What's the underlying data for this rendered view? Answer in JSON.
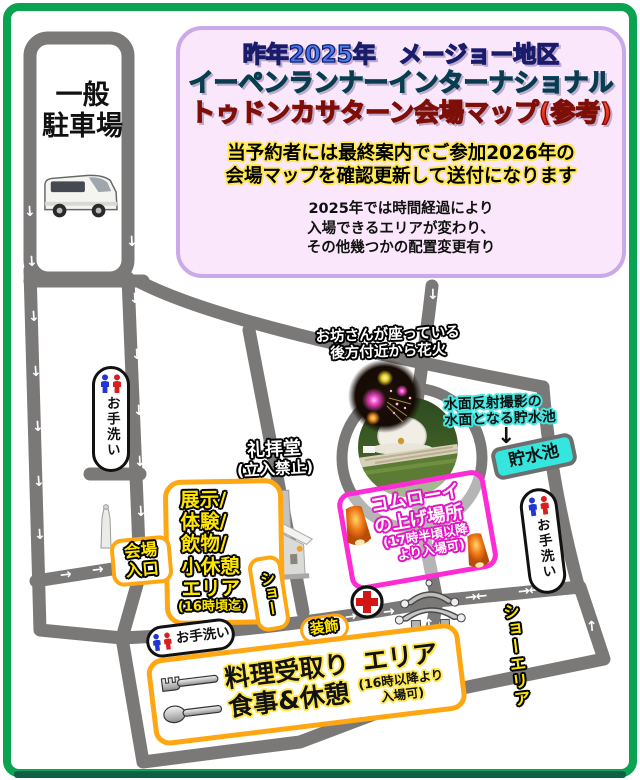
{
  "header": {
    "title_line1": "昨年2025年　メージョー地区",
    "title_line2": "イーペンランナーインターナショナル",
    "title_line3": "トゥドンカサターン会場マップ(参考)",
    "notice_line1": "当予約者には最終案内でご参加2026年の",
    "notice_line2": "会場マップを確認更新して送付になります",
    "note_line1": "2025年では時間経過により",
    "note_line2": "入場できるエリアが変わり、",
    "note_line3": "その他幾つかの配置変更有り"
  },
  "parking": {
    "line1": "一般",
    "line2": "駐車場"
  },
  "map": {
    "fireworks_caption": {
      "line1": "お坊さんが座っている",
      "line2": "後方付近から花火"
    },
    "pond": {
      "caption_line1": "水面反射撮影の",
      "caption_line2": "水面となる貯水池",
      "arrow_glyph": "↓",
      "badge": "貯水池"
    },
    "chapel": {
      "name": "礼拝堂",
      "note": "(立入禁止)"
    },
    "exhibit": {
      "line1": "展示/",
      "line2": "体験/",
      "line3": "飲物/",
      "line4": "小休憩",
      "line5": "エリア",
      "time": "(16時頃迄)"
    },
    "entrance": {
      "line1": "会場",
      "line2": "入口"
    },
    "show_lane": {
      "label": "ショー"
    },
    "komloy": {
      "line1": "コムローイ",
      "line2": "の上げ場所",
      "line3": "(17時半頃以降",
      "line4": "より入場可)"
    },
    "decoration": {
      "label": "装飾"
    },
    "food": {
      "title_left": "料理受取り",
      "title_right": "エリア",
      "title_line2": "食事&休憩",
      "sub_line1": "(16時以降より",
      "sub_line2": "入場可)"
    },
    "show_area": {
      "label": "ショーエリア"
    },
    "toilet": {
      "label": "お手洗い"
    },
    "arrow_marks": [
      {
        "x": 24,
        "y": 205,
        "g": "↓",
        "r": -4
      },
      {
        "x": 26,
        "y": 255,
        "g": "↓",
        "r": -4
      },
      {
        "x": 28,
        "y": 310,
        "g": "↓",
        "r": -4
      },
      {
        "x": 30,
        "y": 365,
        "g": "↓",
        "r": -4
      },
      {
        "x": 32,
        "y": 420,
        "g": "↓",
        "r": -4
      },
      {
        "x": 33,
        "y": 475,
        "g": "↓",
        "r": -4
      },
      {
        "x": 34,
        "y": 528,
        "g": "↓",
        "r": -4
      },
      {
        "x": 126,
        "y": 235,
        "g": "↓",
        "r": -3
      },
      {
        "x": 129,
        "y": 292,
        "g": "↓",
        "r": -3
      },
      {
        "x": 131,
        "y": 348,
        "g": "↓",
        "r": -3
      },
      {
        "x": 133,
        "y": 404,
        "g": "↓",
        "r": -3
      },
      {
        "x": 134,
        "y": 455,
        "g": "↓",
        "r": -3
      },
      {
        "x": 135,
        "y": 505,
        "g": "↓",
        "r": -3
      },
      {
        "x": 427,
        "y": 288,
        "g": "↓",
        "r": 0
      },
      {
        "x": 60,
        "y": 568,
        "g": "→",
        "r": -7
      },
      {
        "x": 92,
        "y": 563,
        "g": "→",
        "r": -7
      },
      {
        "x": 237,
        "y": 540,
        "g": "→",
        "r": -7
      },
      {
        "x": 150,
        "y": 648,
        "g": "→←",
        "r": -7
      },
      {
        "x": 194,
        "y": 643,
        "g": "→←",
        "r": -7
      },
      {
        "x": 345,
        "y": 610,
        "g": "→",
        "r": -7
      },
      {
        "x": 383,
        "y": 605,
        "g": "→",
        "r": -7
      },
      {
        "x": 465,
        "y": 590,
        "g": "→←",
        "r": -6
      },
      {
        "x": 518,
        "y": 584,
        "g": "→←",
        "r": -6
      },
      {
        "x": 423,
        "y": 618,
        "g": "↑",
        "r": -3
      },
      {
        "x": 420,
        "y": 648,
        "g": "↑",
        "r": -3
      },
      {
        "x": 586,
        "y": 620,
        "g": "↑",
        "r": -5
      }
    ]
  },
  "colors": {
    "frame_green": "#0aa352",
    "frame_dark_green": "#0d5f47",
    "road_gray": "#7b7878",
    "accent_orange": "#ffa713",
    "magenta": "#ff2bd4",
    "pond_cyan": "#35e6de",
    "label_yellow": "#ffe600",
    "title_box_bg": "#fbe7fb",
    "title_box_border": "#c9a9e9"
  }
}
